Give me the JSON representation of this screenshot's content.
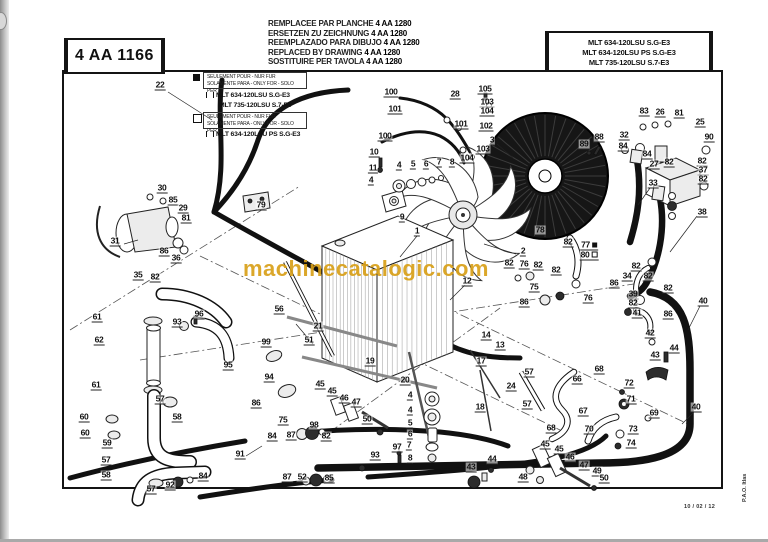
{
  "header": {
    "plate_number": "4 AA 1166",
    "replacement_lines": [
      {
        "text": "REMPLACEE PAR PLANCHE",
        "number": "4 AA 1280"
      },
      {
        "text": "ERSETZEN ZU ZEICHNUNG",
        "number": "4 AA 1280"
      },
      {
        "text": "REEMPLAZADO PARA DIBUJO",
        "number": "4 AA 1280"
      },
      {
        "text": "REPLACED BY DRAWING",
        "number": "4 AA 1280"
      },
      {
        "text": "SOSTITUIRE PER TAVOLA",
        "number": "4 AA 1280"
      }
    ],
    "models_box": [
      "MLT 634-120LSU S.G-E3",
      "MLT 634-120LSU PS S.G-E3",
      "MLT 735-120LSU S.7-E3"
    ]
  },
  "legend": {
    "note_line1": "SEULEMENT POUR - NUR FUR",
    "note_line2": "SOLAMENTE PARA - ONLY FOR - SOLO PER",
    "black_marker_models": [
      "MLT 634-120LSU S.G-E3",
      "MLT 735-120LSU S.7-E3"
    ],
    "white_marker_models": [
      "MLT 634-120LSU PS S.G-E3"
    ]
  },
  "footer": {
    "date": "10 / 02 / 12",
    "side_note": "P.A.O. Itlas"
  },
  "watermark": {
    "text": "machinecatalogic.com",
    "color": "#d8a019"
  },
  "callouts": [
    {
      "n": "100",
      "x": 391,
      "y": 93
    },
    {
      "n": "28",
      "x": 455,
      "y": 95
    },
    {
      "n": "105",
      "x": 485,
      "y": 90
    },
    {
      "n": "103",
      "x": 487,
      "y": 103
    },
    {
      "n": "104",
      "x": 487,
      "y": 112
    },
    {
      "n": "101",
      "x": 395,
      "y": 110
    },
    {
      "n": "101",
      "x": 461,
      "y": 125
    },
    {
      "n": "100",
      "x": 385,
      "y": 137
    },
    {
      "n": "102",
      "x": 486,
      "y": 127
    },
    {
      "n": "3",
      "x": 492,
      "y": 141
    },
    {
      "n": "103",
      "x": 483,
      "y": 150
    },
    {
      "n": "104",
      "x": 467,
      "y": 159
    },
    {
      "n": "10",
      "x": 374,
      "y": 153
    },
    {
      "n": "11",
      "x": 373,
      "y": 169
    },
    {
      "n": "4",
      "x": 371,
      "y": 181
    },
    {
      "n": "4",
      "x": 399,
      "y": 166
    },
    {
      "n": "5",
      "x": 413,
      "y": 165
    },
    {
      "n": "6",
      "x": 426,
      "y": 165
    },
    {
      "n": "7",
      "x": 439,
      "y": 163
    },
    {
      "n": "8",
      "x": 452,
      "y": 163
    },
    {
      "n": "83",
      "x": 644,
      "y": 112
    },
    {
      "n": "26",
      "x": 660,
      "y": 113
    },
    {
      "n": "81",
      "x": 679,
      "y": 114
    },
    {
      "n": "25",
      "x": 700,
      "y": 123
    },
    {
      "n": "88",
      "x": 599,
      "y": 138
    },
    {
      "n": "32",
      "x": 624,
      "y": 136
    },
    {
      "n": "90",
      "x": 709,
      "y": 138
    },
    {
      "n": "89",
      "x": 584,
      "y": 145
    },
    {
      "n": "84",
      "x": 623,
      "y": 147
    },
    {
      "n": "84",
      "x": 647,
      "y": 155
    },
    {
      "n": "27",
      "x": 654,
      "y": 165
    },
    {
      "n": "82",
      "x": 669,
      "y": 163
    },
    {
      "n": "82",
      "x": 702,
      "y": 162
    },
    {
      "n": "37",
      "x": 703,
      "y": 171
    },
    {
      "n": "82",
      "x": 703,
      "y": 180
    },
    {
      "n": "33",
      "x": 653,
      "y": 184
    },
    {
      "n": "38",
      "x": 702,
      "y": 213
    },
    {
      "n": "82",
      "x": 636,
      "y": 267
    },
    {
      "n": "34",
      "x": 627,
      "y": 277
    },
    {
      "n": "82",
      "x": 648,
      "y": 277
    },
    {
      "n": "82",
      "x": 668,
      "y": 289
    },
    {
      "n": "39",
      "x": 633,
      "y": 295
    },
    {
      "n": "82",
      "x": 633,
      "y": 304
    },
    {
      "n": "40",
      "x": 703,
      "y": 302
    },
    {
      "n": "41",
      "x": 637,
      "y": 314
    },
    {
      "n": "86",
      "x": 668,
      "y": 315
    },
    {
      "n": "22",
      "x": 160,
      "y": 86
    },
    {
      "n": "30",
      "x": 162,
      "y": 189
    },
    {
      "n": "85",
      "x": 173,
      "y": 201
    },
    {
      "n": "29",
      "x": 183,
      "y": 209
    },
    {
      "n": "81",
      "x": 186,
      "y": 219
    },
    {
      "n": "31",
      "x": 115,
      "y": 242
    },
    {
      "n": "86",
      "x": 164,
      "y": 252
    },
    {
      "n": "36",
      "x": 176,
      "y": 259
    },
    {
      "n": "35",
      "x": 138,
      "y": 276
    },
    {
      "n": "82",
      "x": 155,
      "y": 278
    },
    {
      "n": "79",
      "x": 261,
      "y": 206
    },
    {
      "n": "56",
      "x": 279,
      "y": 310
    },
    {
      "n": "9",
      "x": 402,
      "y": 218
    },
    {
      "n": "1",
      "x": 417,
      "y": 232
    },
    {
      "n": "2",
      "x": 523,
      "y": 252
    },
    {
      "n": "12",
      "x": 467,
      "y": 282
    },
    {
      "n": "82",
      "x": 509,
      "y": 264
    },
    {
      "n": "78",
      "x": 540,
      "y": 231
    },
    {
      "n": "82",
      "x": 568,
      "y": 243
    },
    {
      "n": "77",
      "x": 589,
      "y": 246,
      "sq": "black"
    },
    {
      "n": "80",
      "x": 589,
      "y": 256,
      "sq": "white"
    },
    {
      "n": "76",
      "x": 524,
      "y": 265
    },
    {
      "n": "82",
      "x": 538,
      "y": 266
    },
    {
      "n": "82",
      "x": 556,
      "y": 271
    },
    {
      "n": "75",
      "x": 534,
      "y": 288
    },
    {
      "n": "86",
      "x": 614,
      "y": 284
    },
    {
      "n": "86",
      "x": 524,
      "y": 303
    },
    {
      "n": "76",
      "x": 588,
      "y": 299
    },
    {
      "n": "21",
      "x": 318,
      "y": 327
    },
    {
      "n": "51",
      "x": 309,
      "y": 341
    },
    {
      "n": "19",
      "x": 370,
      "y": 362
    },
    {
      "n": "20",
      "x": 405,
      "y": 381
    },
    {
      "n": "14",
      "x": 486,
      "y": 336
    },
    {
      "n": "13",
      "x": 500,
      "y": 346
    },
    {
      "n": "17",
      "x": 481,
      "y": 362
    },
    {
      "n": "57",
      "x": 529,
      "y": 373
    },
    {
      "n": "24",
      "x": 511,
      "y": 387
    },
    {
      "n": "57",
      "x": 527,
      "y": 405
    },
    {
      "n": "18",
      "x": 480,
      "y": 408
    },
    {
      "n": "61",
      "x": 97,
      "y": 318
    },
    {
      "n": "93",
      "x": 177,
      "y": 323
    },
    {
      "n": "96",
      "x": 199,
      "y": 315
    },
    {
      "n": "62",
      "x": 99,
      "y": 341
    },
    {
      "n": "95",
      "x": 228,
      "y": 366
    },
    {
      "n": "61",
      "x": 96,
      "y": 386
    },
    {
      "n": "57",
      "x": 160,
      "y": 400
    },
    {
      "n": "60",
      "x": 84,
      "y": 418
    },
    {
      "n": "58",
      "x": 177,
      "y": 418
    },
    {
      "n": "60",
      "x": 85,
      "y": 434
    },
    {
      "n": "59",
      "x": 107,
      "y": 444
    },
    {
      "n": "57",
      "x": 106,
      "y": 461
    },
    {
      "n": "58",
      "x": 106,
      "y": 476
    },
    {
      "n": "57",
      "x": 151,
      "y": 490
    },
    {
      "n": "92",
      "x": 170,
      "y": 486
    },
    {
      "n": "84",
      "x": 203,
      "y": 477
    },
    {
      "n": "99",
      "x": 266,
      "y": 343
    },
    {
      "n": "94",
      "x": 269,
      "y": 378
    },
    {
      "n": "45",
      "x": 320,
      "y": 385
    },
    {
      "n": "45",
      "x": 332,
      "y": 392
    },
    {
      "n": "46",
      "x": 344,
      "y": 399
    },
    {
      "n": "47",
      "x": 356,
      "y": 403
    },
    {
      "n": "86",
      "x": 256,
      "y": 404
    },
    {
      "n": "75",
      "x": 283,
      "y": 421
    },
    {
      "n": "50",
      "x": 367,
      "y": 420
    },
    {
      "n": "84",
      "x": 272,
      "y": 437
    },
    {
      "n": "87",
      "x": 291,
      "y": 436
    },
    {
      "n": "98",
      "x": 314,
      "y": 426
    },
    {
      "n": "82",
      "x": 326,
      "y": 437
    },
    {
      "n": "91",
      "x": 240,
      "y": 455
    },
    {
      "n": "93",
      "x": 375,
      "y": 456
    },
    {
      "n": "87",
      "x": 287,
      "y": 478
    },
    {
      "n": "52",
      "x": 302,
      "y": 478
    },
    {
      "n": "85",
      "x": 329,
      "y": 479
    },
    {
      "n": "4",
      "x": 410,
      "y": 396
    },
    {
      "n": "4",
      "x": 410,
      "y": 411
    },
    {
      "n": "5",
      "x": 410,
      "y": 424
    },
    {
      "n": "6",
      "x": 410,
      "y": 435
    },
    {
      "n": "7",
      "x": 409,
      "y": 446
    },
    {
      "n": "97",
      "x": 397,
      "y": 448
    },
    {
      "n": "8",
      "x": 410,
      "y": 459
    },
    {
      "n": "68",
      "x": 551,
      "y": 429
    },
    {
      "n": "45",
      "x": 545,
      "y": 445
    },
    {
      "n": "44",
      "x": 492,
      "y": 460
    },
    {
      "n": "43",
      "x": 471,
      "y": 468
    },
    {
      "n": "48",
      "x": 523,
      "y": 478
    },
    {
      "n": "42",
      "x": 650,
      "y": 334
    },
    {
      "n": "44",
      "x": 674,
      "y": 349
    },
    {
      "n": "43",
      "x": 655,
      "y": 356
    },
    {
      "n": "68",
      "x": 599,
      "y": 370
    },
    {
      "n": "66",
      "x": 577,
      "y": 380
    },
    {
      "n": "72",
      "x": 629,
      "y": 384
    },
    {
      "n": "71",
      "x": 631,
      "y": 400
    },
    {
      "n": "40",
      "x": 696,
      "y": 408
    },
    {
      "n": "67",
      "x": 583,
      "y": 412
    },
    {
      "n": "69",
      "x": 654,
      "y": 414
    },
    {
      "n": "70",
      "x": 589,
      "y": 430
    },
    {
      "n": "73",
      "x": 633,
      "y": 430
    },
    {
      "n": "74",
      "x": 631,
      "y": 444
    },
    {
      "n": "45",
      "x": 559,
      "y": 450
    },
    {
      "n": "46",
      "x": 570,
      "y": 458
    },
    {
      "n": "47",
      "x": 584,
      "y": 466
    },
    {
      "n": "49",
      "x": 597,
      "y": 472
    },
    {
      "n": "50",
      "x": 604,
      "y": 479
    }
  ]
}
